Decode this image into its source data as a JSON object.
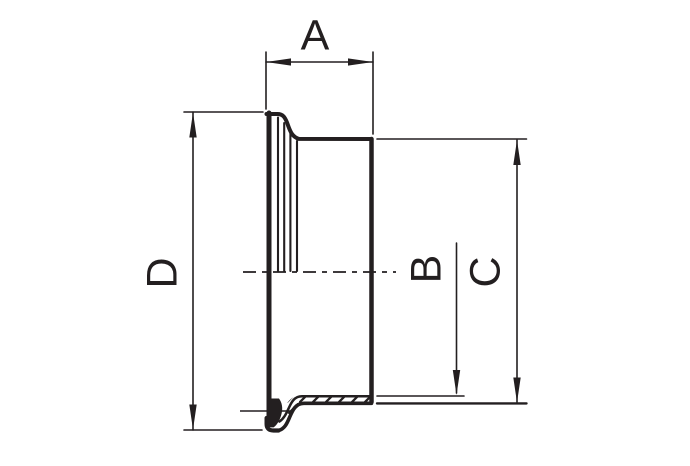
{
  "drawing": {
    "type": "technical-dimension-drawing",
    "colors": {
      "ink": "#231f20",
      "background": "#ffffff"
    },
    "dimensions": {
      "a": {
        "label": "A",
        "orientation": "horizontal"
      },
      "b": {
        "label": "B",
        "orientation": "vertical"
      },
      "c": {
        "label": "C",
        "orientation": "vertical"
      },
      "d": {
        "label": "D",
        "orientation": "vertical"
      }
    }
  }
}
